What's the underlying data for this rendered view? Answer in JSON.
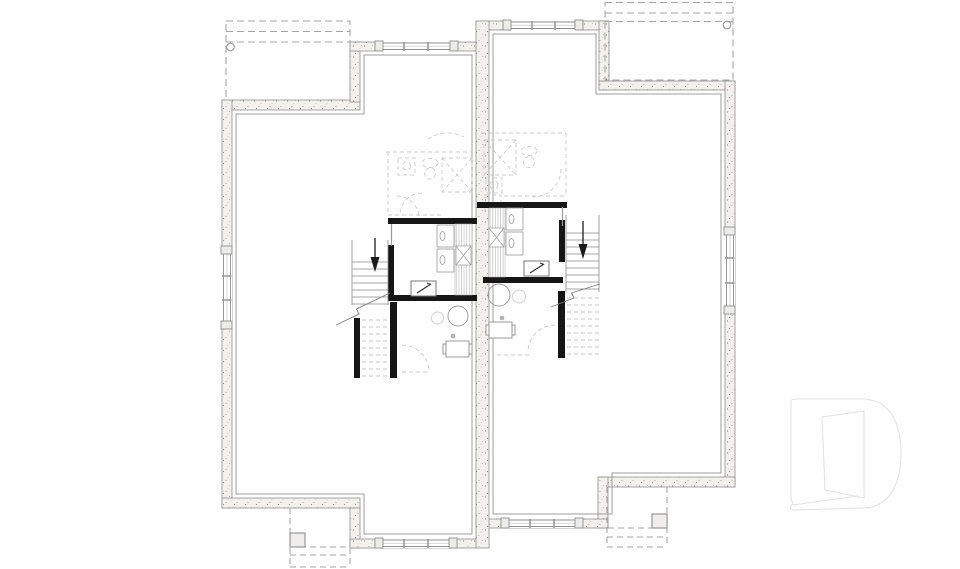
{
  "page": {
    "background": "#ffffff",
    "kind": "basement-foundation-floor-plan",
    "description": "Mirrored semi-detached basement plan, no visible text labels"
  },
  "palette": {
    "wall_fill": "#f2f1ee",
    "wall_line": "#8f8f8f",
    "inner_line": "#9c9c9c",
    "partition_black": "#161616",
    "fixture_line": "#9a9a9a",
    "faint_line": "#cbcbcb",
    "dashed_line": "#a6a6a6",
    "stair_line": "#8a8a8a",
    "stair_dashed": "#c4c4c4",
    "watermark_line": "#e3e3e3",
    "pier_fill": "#efeeec",
    "dot_fill": "#b0b0b0"
  },
  "plan": {
    "units": [
      {
        "id": "unit-left",
        "side": "left",
        "stair_direction": "down",
        "piers": 2
      },
      {
        "id": "unit-right",
        "side": "right",
        "stair_direction": "down",
        "piers": 2
      }
    ],
    "shared": {
      "party_wall": true
    },
    "dashed_features": [
      "rear-deck-left",
      "rear-deck-right",
      "front-porch-left",
      "front-porch-right",
      "upper-floor-bathroom-overlays"
    ]
  },
  "watermark": {
    "letter": "D",
    "name": "builder-logo"
  }
}
